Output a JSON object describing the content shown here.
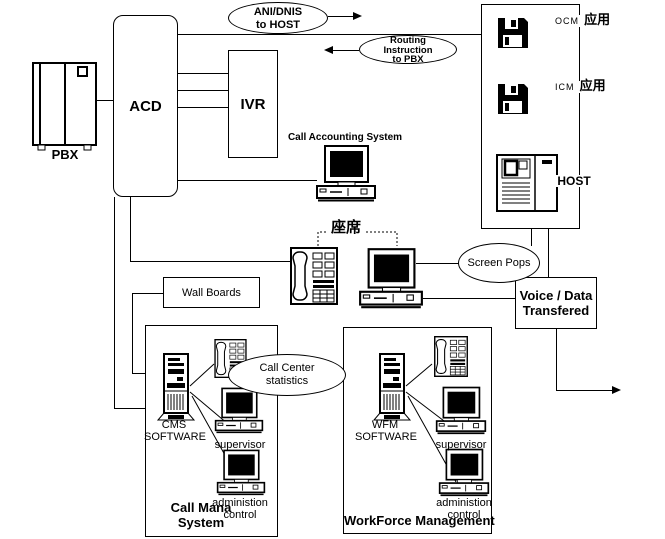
{
  "colors": {
    "ink": "#000000",
    "bg": "#ffffff"
  },
  "nodes": {
    "pbx": "PBX",
    "acd": "ACD",
    "ivr": "IVR",
    "wall_boards": "Wall Boards",
    "call_accounting": "Call Accounting System",
    "agent_seat": "座席",
    "voice_data": [
      "Voice / Data",
      "Transfered"
    ]
  },
  "flows": {
    "ani_dnis": [
      "ANI/DNIS",
      "to HOST"
    ],
    "routing": [
      "Routing",
      "Instruction",
      "to PBX"
    ],
    "screen_pops": "Screen Pops",
    "call_center_stats": [
      "Call Center",
      "statistics"
    ]
  },
  "host_box": {
    "ocm_label": "OCM",
    "ocm_app": "应用",
    "icm_label": "ICM",
    "icm_app": "应用",
    "host_label": "HOST"
  },
  "cms_box": {
    "software": [
      "CMS",
      "SOFTWARE"
    ],
    "supervisor": "supervisor",
    "admin": [
      "administion",
      "control"
    ],
    "title": [
      "Call Mana",
      "System"
    ]
  },
  "wfm_box": {
    "software": [
      "WFM",
      "SOFTWARE"
    ],
    "supervisor": "supervisor",
    "admin": [
      "administion",
      "control"
    ],
    "title": "WorkForce Management"
  }
}
